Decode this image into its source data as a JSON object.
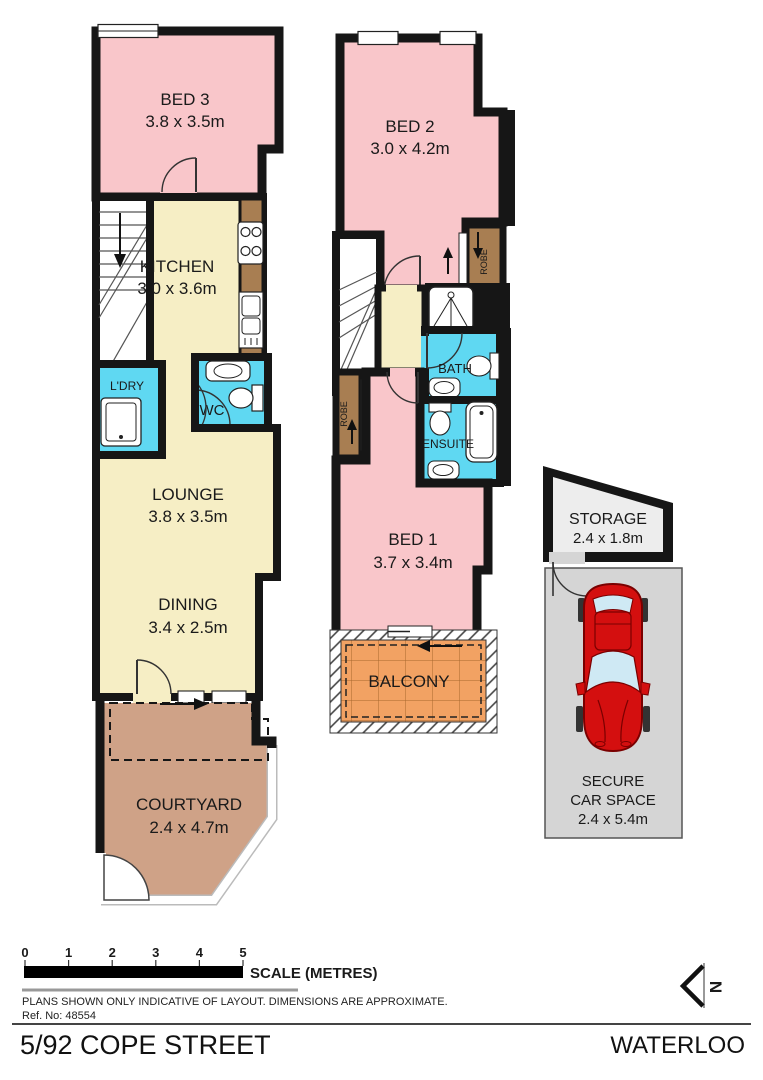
{
  "title_block": {
    "address": "5/92 COPE STREET",
    "suburb": "WATERLOO",
    "ref": "Ref. No: 48554",
    "disclaimer": "PLANS SHOWN ONLY INDICATIVE OF LAYOUT.  DIMENSIONS ARE APPROXIMATE."
  },
  "scale_bar": {
    "label": "SCALE (METRES)",
    "ticks": [
      "0",
      "1",
      "2",
      "3",
      "4",
      "5"
    ]
  },
  "north_indicator": {
    "label": "N"
  },
  "ground_floor": {
    "bed3": {
      "name": "BED 3",
      "dims": "3.8 x 3.5m"
    },
    "kitchen": {
      "name": "KITCHEN",
      "dims": "3.0 x 3.6m"
    },
    "laundry": {
      "name": "L'DRY"
    },
    "wc": {
      "name": "WC"
    },
    "lounge": {
      "name": "LOUNGE",
      "dims": "3.8 x 3.5m"
    },
    "dining": {
      "name": "DINING",
      "dims": "3.4 x 2.5m"
    },
    "courtyard": {
      "name": "COURTYARD",
      "dims": "2.4 x 4.7m"
    }
  },
  "upper_floor": {
    "bed2": {
      "name": "BED 2",
      "dims": "3.0 x 4.2m"
    },
    "robe_bed2": {
      "name": "ROBE"
    },
    "bath": {
      "name": "BATH"
    },
    "ensuite": {
      "name": "ENSUITE"
    },
    "robe_bed1": {
      "name": "ROBE"
    },
    "bed1": {
      "name": "BED 1",
      "dims": "3.7 x 3.4m"
    },
    "balcony": {
      "name": "BALCONY"
    }
  },
  "outbuildings": {
    "storage": {
      "name": "STORAGE",
      "dims": "2.4 x 1.8m"
    },
    "car_space": {
      "name_line1": "SECURE",
      "name_line2": "CAR SPACE",
      "dims": "2.4 x 5.4m"
    }
  },
  "colors": {
    "bedroom_pink": "#f9c6ca",
    "living_cream": "#f6eec5",
    "wet_area_blue": "#5fd8f2",
    "joinery_brown": "#a87e52",
    "courtyard_tan": "#cfa287",
    "balcony_orange": "#f2a263",
    "carspace_grey": "#d5d5d5",
    "storage_grey": "#ededed",
    "car_red": "#d40f0f",
    "wall_black": "#161616"
  }
}
